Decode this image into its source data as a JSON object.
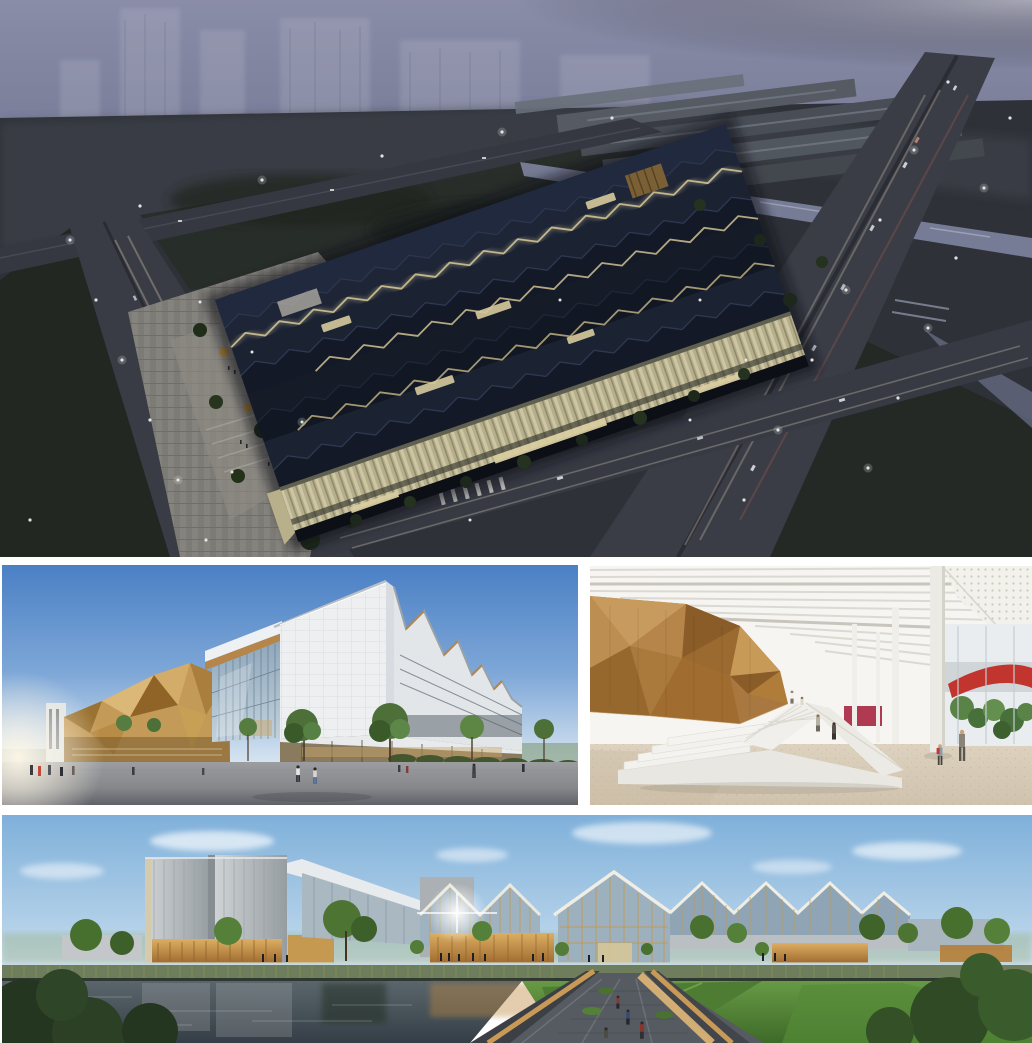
{
  "page": {
    "kind": "architectural rendering collage",
    "background_color": "#ffffff",
    "panel_count": 4,
    "has_text": false
  },
  "panels": {
    "aerial_dusk": {
      "name": "aerial-dusk-view",
      "description": "Aerial dusk rendering of a large exhibition complex with dark folded zigzag roofs, glowing amber roof seams and striped luminous facades, surrounded by highways with light trails, a canal, warehouse sheds and a tree-lined plaza",
      "time_of_day": "dusk",
      "dominant_colors": [
        "#9395b4",
        "#1d2433",
        "#ead9a2",
        "#3e414b"
      ]
    },
    "street_view": {
      "name": "street-level-view",
      "description": "Street-level daytime rendering of white sawtooth-roofed halls with a glass curtain wall and a faceted golden timber volume above a grey plaza with pedestrians, young trees and hedges, sun flare at lower left",
      "time_of_day": "day",
      "dominant_colors": [
        "#4b80c5",
        "#eef0f2",
        "#c49a58",
        "#8d9096"
      ]
    },
    "interior": {
      "name": "interior-atrium-view",
      "description": "Interior rendering with a faceted timber volume floating above a white terraced grand stair, slatted white ceiling with a perforated canopy, slender columns, plants, a red ramp beyond the glass and a speckled beige floor",
      "time_of_day": "day",
      "dominant_colors": [
        "#f4f2ee",
        "#b5854a",
        "#c2342e",
        "#d9cfc0"
      ]
    },
    "waterfront": {
      "name": "waterfront-elevation-view",
      "description": "Waterfront daytime rendering of the complex with silver towers, zigzag glass gables framed in gold and warm timber walls reflected in a canal, reeds on the embankment, a sloping lawn and an angular timber-edged footbridge in the foreground",
      "time_of_day": "day",
      "dominant_colors": [
        "#7fb0da",
        "#b9bec1",
        "#c08c4a",
        "#4e7c33"
      ]
    }
  },
  "layout": {
    "gap_color": "#ffffff",
    "rows": [
      "full-width aerial view",
      "two side-by-side views",
      "full-width waterfront view"
    ]
  }
}
